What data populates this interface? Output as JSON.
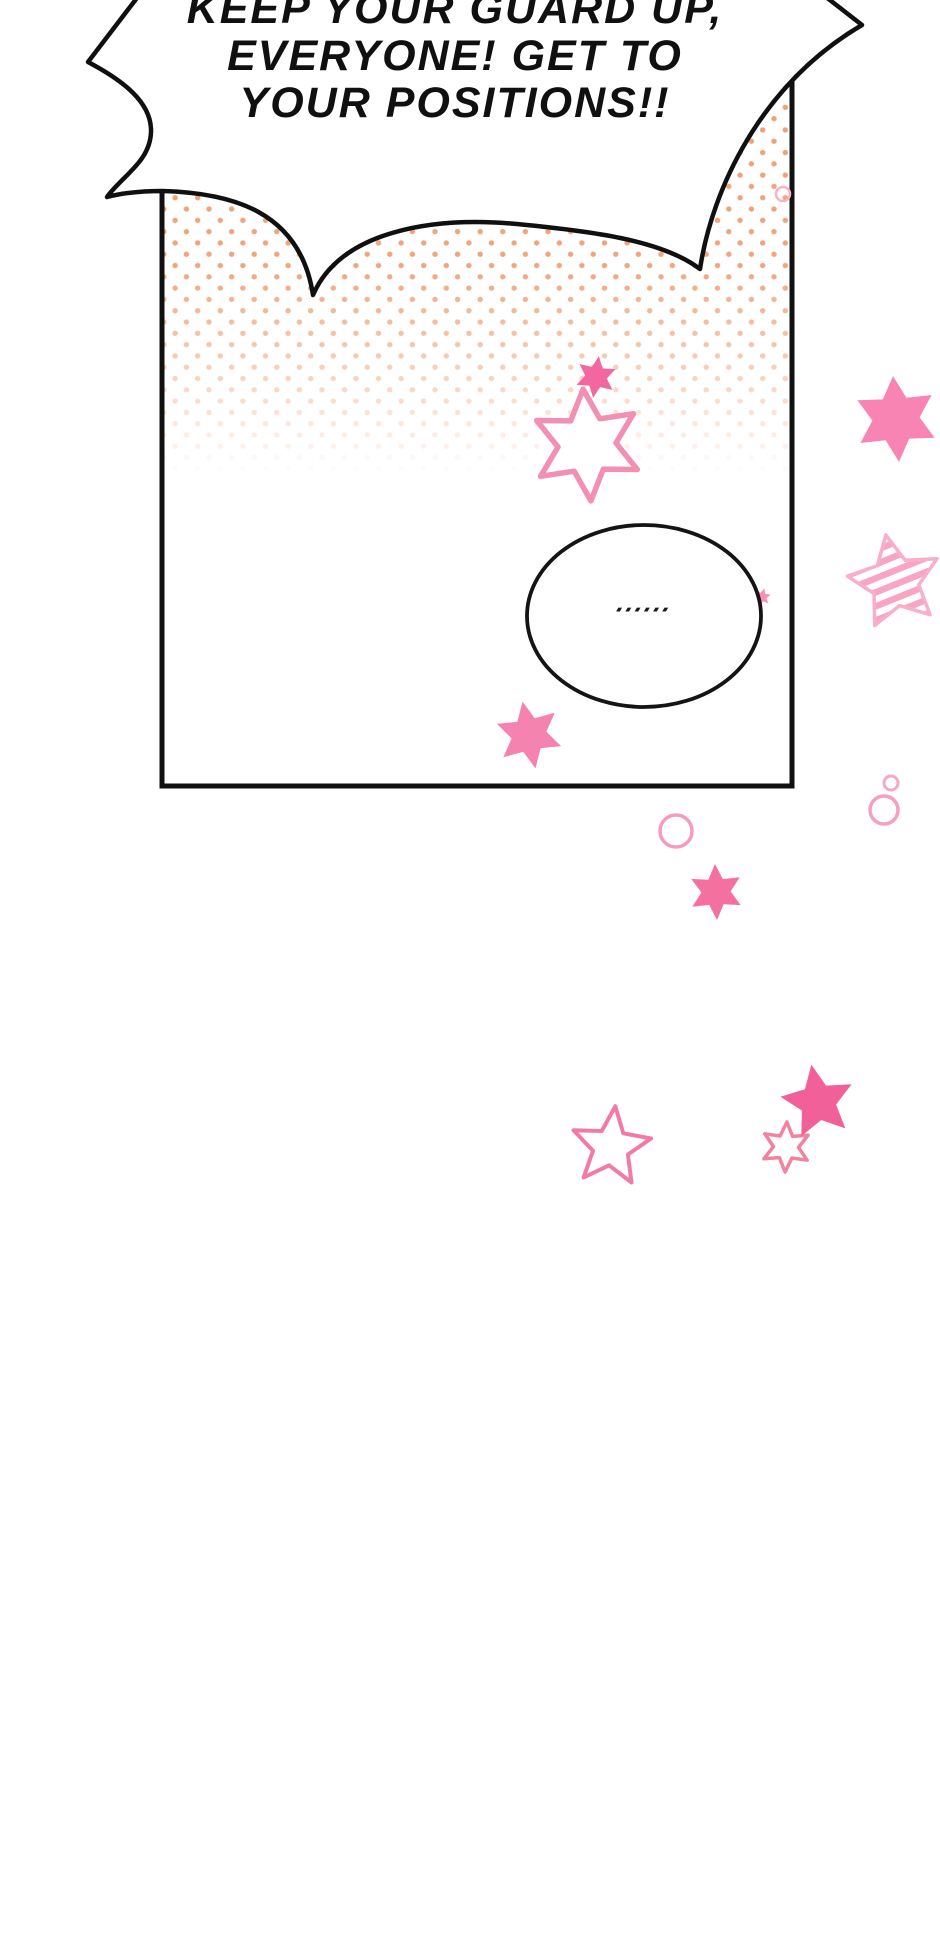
{
  "page": {
    "background": "#FFFFFF",
    "width": 940,
    "height": 1953
  },
  "speech_bubble": {
    "lines": [
      "KEEP YOUR GUARD UP,",
      "EVERYONE! GET TO",
      "YOUR POSITIONS!!"
    ]
  },
  "thought_bubble": {
    "ellipsis": "......"
  },
  "palette": {
    "ink": "#101010",
    "halftone_dot": "#EFA176",
    "pink_strong": "#F2609A",
    "pink_medium": "#F884B4",
    "pink_outline": "#F48FB1",
    "pink_light": "#F8AFC9"
  },
  "decorations": {
    "stars": [
      {
        "name": "star-small-filled-top",
        "layer": "front",
        "cx": 596,
        "cy": 377,
        "outer_r": 21,
        "points": 6,
        "inner_ratio": 0.52,
        "rotation": 8,
        "fill": "#F2679F",
        "stroke": "none",
        "stroke_width": 0
      },
      {
        "name": "star-outline-large",
        "layer": "front",
        "cx": 587,
        "cy": 445,
        "outer_r": 56,
        "points": 6,
        "inner_ratio": 0.52,
        "rotation": -4,
        "fill": "#FFFFFF",
        "stroke": "#F190B3",
        "stroke_width": 5.5
      },
      {
        "name": "star-filled-right-top",
        "layer": "front",
        "cx": 896,
        "cy": 419,
        "outer_r": 43,
        "points": 6,
        "inner_ratio": 0.55,
        "rotation": -4,
        "fill": "#F884B4",
        "stroke": "none",
        "stroke_width": 0
      },
      {
        "name": "star-striped-right",
        "layer": "front",
        "cx": 895,
        "cy": 582,
        "outer_r": 48,
        "points": 5,
        "inner_ratio": 0.5,
        "rotation": -11,
        "fill": "striped",
        "stroke": "#F8AFC9",
        "stroke_width": 3.5
      },
      {
        "name": "star-filled-panel-bottom",
        "layer": "front",
        "cx": 529,
        "cy": 735,
        "outer_r": 34,
        "points": 6,
        "inner_ratio": 0.52,
        "rotation": -11,
        "fill": "#F583B0",
        "stroke": "none",
        "stroke_width": 0
      },
      {
        "name": "star-filled-below-panel",
        "layer": "front",
        "cx": 716,
        "cy": 892,
        "outer_r": 28,
        "points": 6,
        "inner_ratio": 0.52,
        "rotation": -2,
        "fill": "#F4719F",
        "stroke": "none",
        "stroke_width": 0
      },
      {
        "name": "star-outline-bottom-left",
        "layer": "front",
        "cx": 611,
        "cy": 1147,
        "outer_r": 41,
        "points": 5,
        "inner_ratio": 0.45,
        "rotation": 6,
        "fill": "none",
        "stroke": "#F27BA5",
        "stroke_width": 4
      },
      {
        "name": "star-outline-bottom-small",
        "layer": "front",
        "cx": 786,
        "cy": 1147,
        "outer_r": 25,
        "points": 6,
        "inner_ratio": 0.5,
        "rotation": 2,
        "fill": "#FFFFFF",
        "stroke": "#F1839F",
        "stroke_width": 3.5
      },
      {
        "name": "star-filled-bottom-right",
        "layer": "front",
        "cx": 818,
        "cy": 1102,
        "outer_r": 38,
        "points": 5,
        "inner_ratio": 0.48,
        "rotation": -10,
        "fill": "#F2609A",
        "stroke": "none",
        "stroke_width": 0
      },
      {
        "name": "star-speck-behind-ellipse",
        "layer": "behind",
        "cx": 762,
        "cy": 597,
        "outer_r": 9,
        "points": 6,
        "inner_ratio": 0.5,
        "rotation": 15,
        "fill": "#F78FB6",
        "stroke": "none",
        "stroke_width": 0
      }
    ],
    "circles": [
      {
        "name": "circle-outline-top-right",
        "layer": "front",
        "cx": 783,
        "cy": 194,
        "r": 7,
        "stroke": "#F9B0C8",
        "stroke_width": 2.5
      },
      {
        "name": "circle-outline-below-panel",
        "layer": "front",
        "cx": 676,
        "cy": 831,
        "r": 16,
        "stroke": "#F69BBA",
        "stroke_width": 3.5
      },
      {
        "name": "circle-outline-small-right",
        "layer": "front",
        "cx": 891,
        "cy": 783,
        "r": 7,
        "stroke": "#F7A8C2",
        "stroke_width": 3
      },
      {
        "name": "circle-outline-right",
        "layer": "front",
        "cx": 884,
        "cy": 810,
        "r": 14,
        "stroke": "#F7A0BC",
        "stroke_width": 3.5
      }
    ]
  }
}
